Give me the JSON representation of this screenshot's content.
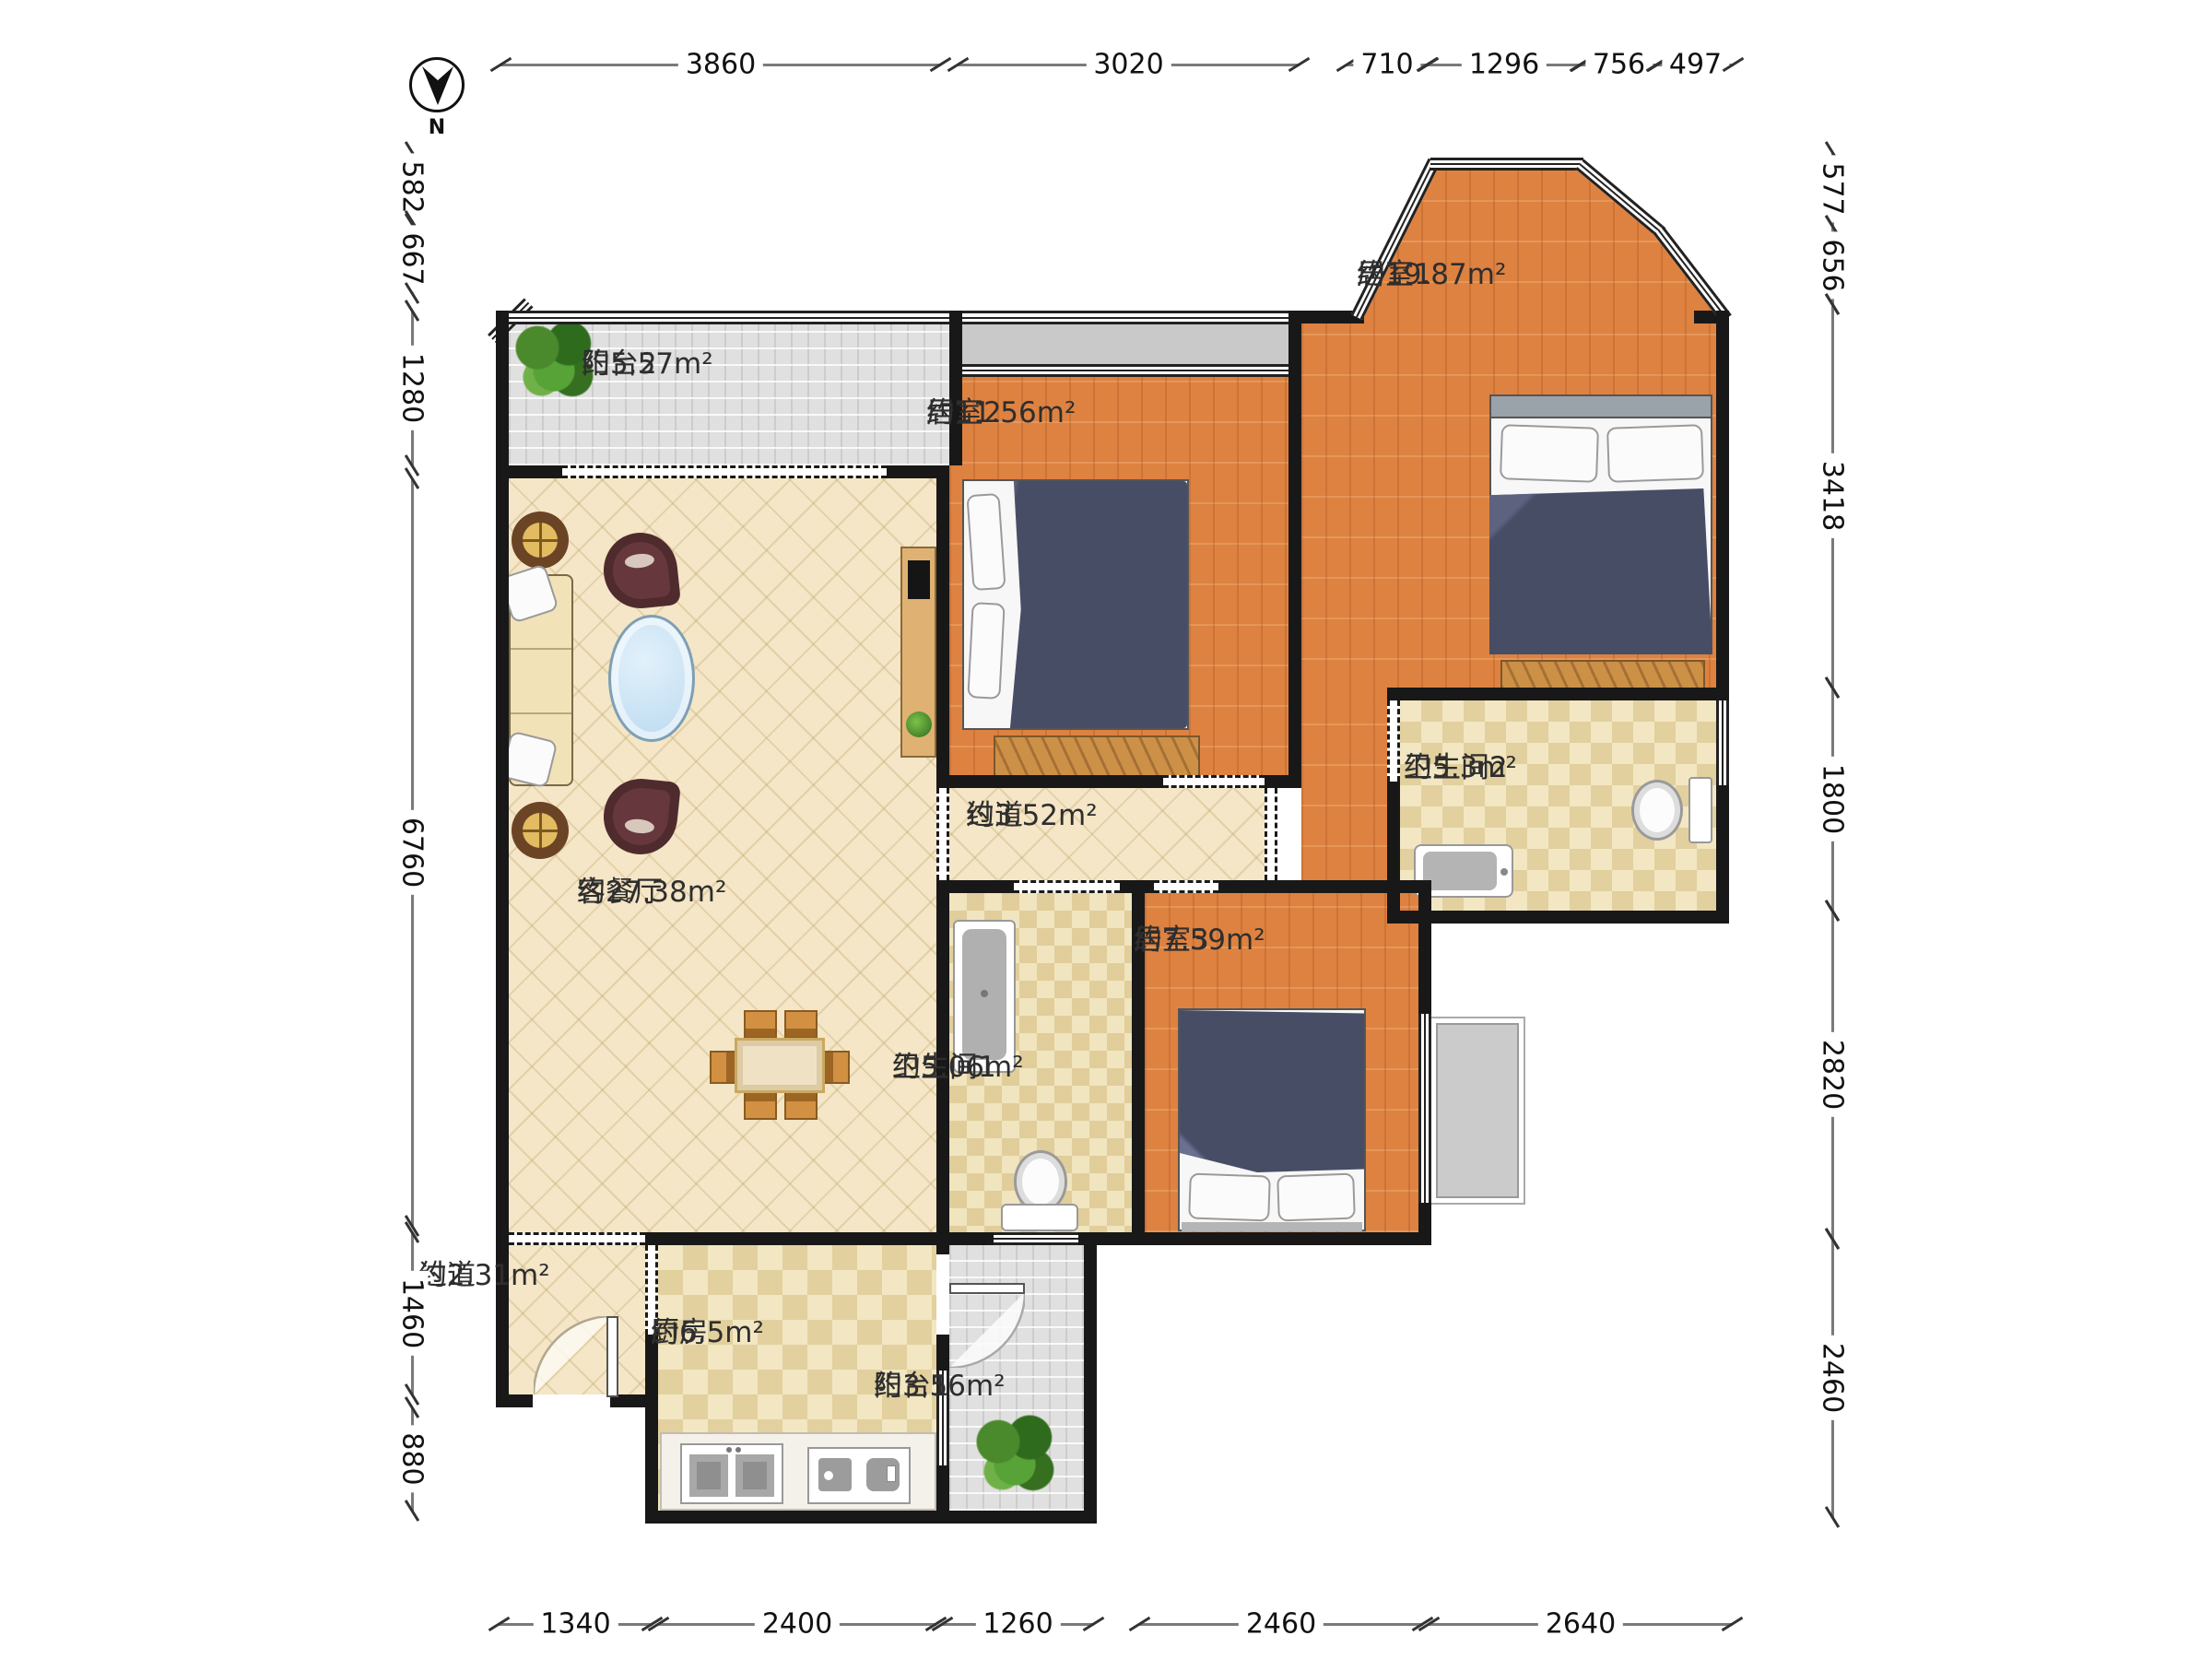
{
  "compass": {
    "label": "N"
  },
  "rooms": [
    {
      "id": "balcony2",
      "name": "阳台2",
      "area": "约5.57m²"
    },
    {
      "id": "bedroom2",
      "name": "居室2",
      "area": "约11.56m²"
    },
    {
      "id": "bedroom1",
      "name": "居室1",
      "area": "约19.87m²"
    },
    {
      "id": "living",
      "name": "客餐厅",
      "area": "约27.38m²"
    },
    {
      "id": "hallway1",
      "name": "过道",
      "area": "约3.52m²"
    },
    {
      "id": "bath2",
      "name": "卫生间2",
      "area": "约5.3m²"
    },
    {
      "id": "bedroom3",
      "name": "居室3",
      "area": "约7.59m²"
    },
    {
      "id": "bath1",
      "name": "卫生间1",
      "area": "约5.06m²"
    },
    {
      "id": "hallway2",
      "name": "过道",
      "area": "约2.31m²"
    },
    {
      "id": "kitchen",
      "name": "厨房",
      "area": "约6.5m²"
    },
    {
      "id": "balcony1",
      "name": "阳台1",
      "area": "约3.56m²"
    }
  ],
  "dimensions": {
    "top": [
      {
        "label": "3860"
      },
      {
        "label": "3020"
      },
      {
        "label": "710"
      },
      {
        "label": "1296"
      },
      {
        "label": "756"
      },
      {
        "label": "497"
      }
    ],
    "left": [
      {
        "label": "582"
      },
      {
        "label": "667"
      },
      {
        "label": "1280"
      },
      {
        "label": "6760"
      },
      {
        "label": "1460"
      },
      {
        "label": "880"
      }
    ],
    "right": [
      {
        "label": "577"
      },
      {
        "label": "656"
      },
      {
        "label": "3418"
      },
      {
        "label": "1800"
      },
      {
        "label": "2820"
      },
      {
        "label": "2460"
      }
    ],
    "bottom": [
      {
        "label": "1340"
      },
      {
        "label": "2400"
      },
      {
        "label": "1260"
      },
      {
        "label": "2460"
      },
      {
        "label": "2640"
      }
    ]
  },
  "colors": {
    "wall": "#181818",
    "wood_floor": "#de8241",
    "living_floor": "#f4e6c6",
    "tile_floor": "#f2e7c2",
    "balcony_floor": "#e0e0e0",
    "bed_blanket": "#484d66",
    "coffee_table": "#cfe6f7",
    "plant_green": "#4a8a2c"
  }
}
